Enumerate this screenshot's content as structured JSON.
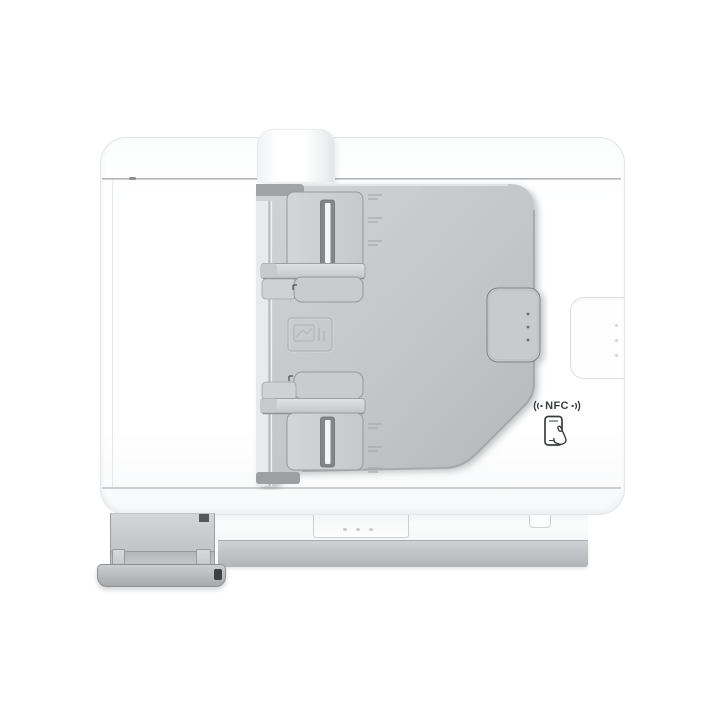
{
  "photo": {
    "description": "Top-down product photo of a white multifunction printer: gray automatic document feeder tray with adjustable paper guides, NFC tap zone on the right, front output tray extended at bottom left",
    "background": "#ffffff"
  },
  "nfc": {
    "label": "NFC"
  },
  "icons": {
    "nfc_wave_left": "nfc-signal-wave-left-icon",
    "nfc_wave_right": "nfc-signal-wave-right-icon",
    "smartphone_tap": "smartphone-tap-icon",
    "paper_load_emboss": "paper-load-embossed-icon"
  },
  "colors": {
    "page_bg": "#ffffff",
    "body_white": "#fdfdfe",
    "tray_gray": "#c2c5c8",
    "guide_gray": "#ced1d3",
    "slot_dark": "#7e8184",
    "cap_dark": "#a2a5a8",
    "base_gray": "#bfc2c5",
    "ink_dark": "#3a3d40"
  }
}
